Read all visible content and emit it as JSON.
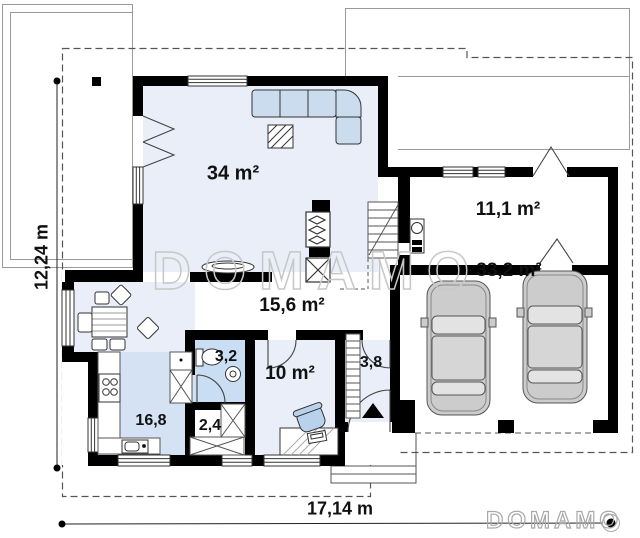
{
  "plan": {
    "title": "single-storey house floor plan with garage",
    "rooms": [
      {
        "name": "living-room",
        "label": "34 m²"
      },
      {
        "name": "hall",
        "label": "15,6 m²"
      },
      {
        "name": "utility-room",
        "label": "11,1 m²"
      },
      {
        "name": "garage",
        "label": "33,2 m²"
      },
      {
        "name": "bedroom",
        "label": "10 m²"
      },
      {
        "name": "bathroom",
        "label": "3,2"
      },
      {
        "name": "vestibule",
        "label": "3,8"
      },
      {
        "name": "kitchen",
        "label": "16,8"
      },
      {
        "name": "wardrobe",
        "label": "2,4"
      }
    ],
    "dimensions": {
      "horizontal": "17,14 m",
      "vertical": "12,24 m"
    },
    "watermark": "DOMAMO",
    "logo": "DOMAMO",
    "colors": {
      "wall": "#000000",
      "floor_light": "#e9eef8",
      "floor_kitchen": "#d4e2f3",
      "floor_bath": "#c9def2",
      "furniture_blue": "#ccdcef",
      "car_gray": "#cccccc",
      "watermark_gray": "#c7c7c7"
    }
  }
}
